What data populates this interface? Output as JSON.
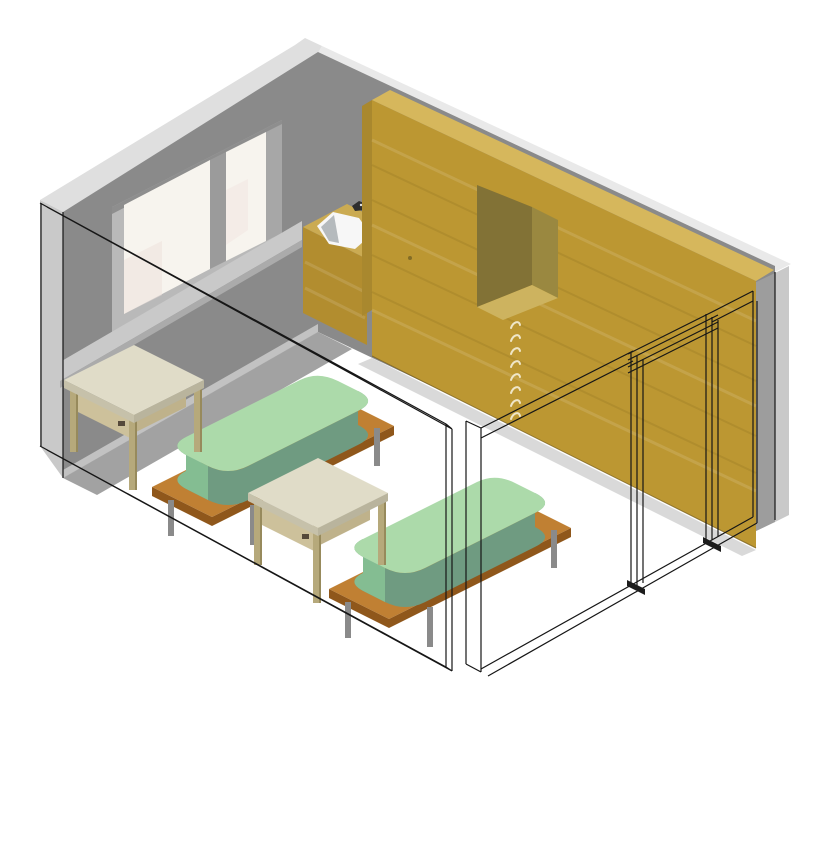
{
  "scene": {
    "view": "isometric-3d-room",
    "background": "#FFFFFF",
    "palette": {
      "outline": "#161616",
      "wall_gray": "#8A8A8A",
      "wall_gray_right": "#9D9D9D",
      "wall_cut_light": "#C9C9C9",
      "wall_top_band_left": "#DFDFDF",
      "wall_top_band_right": "#E9E9E9",
      "sill_band": "#C9C9C9",
      "sill_edge": "#ABABAB",
      "baseboard": "#C2C2C2",
      "floor_shadow": "#A2A2A2",
      "shadow_soft": "#ABABAB",
      "window_reveal": "#B9B9B9",
      "window_reveal_dark": "#8E8E8E",
      "window_pane": "#F7F4EE",
      "window_tint": "#EFE2DC",
      "window_mullion": "#9B9B9B",
      "window_frame_right": "#A7A7A7",
      "cabinet_front": "#BC9732",
      "cabinet_top": "#D6B75C",
      "cabinet_side": "#A9882E",
      "cabinet_base_line": "#7A621F",
      "niche_back": "#827236",
      "niche_jamb": "#9A8840",
      "niche_sill": "#CDB35F",
      "handle": "#EFE6C8",
      "keyhole": "#6B5A1F",
      "counter_front": "#B28D2F",
      "counter_top": "#CBAB52",
      "basin": "#F7F7F7",
      "basin_shadow": "#A9AFB3",
      "faucet": "#2E2E2E",
      "mattress_top": "#ACDAAA",
      "mattress_side": "#6F9B81",
      "mattress_end": "#84BD92",
      "platform_top": "#C08033",
      "platform_side": "#8F571B",
      "bed_leg": "#8A8A8A",
      "table_top": "#E0DCC8",
      "table_edge_a": "#C6C1AA",
      "table_edge_b": "#B9B49D",
      "table_leg": "#B6A97B",
      "table_leg_dark": "#978A5C",
      "table_apron": "#CDC19B",
      "table_apron_b": "#BFB28B",
      "drawer_pull_dark": "#55493A",
      "door_foot": "#1C1C1C"
    },
    "objects": [
      {
        "id": "room-shell",
        "label": "room shell with section-cut front walls"
      },
      {
        "id": "window",
        "label": "two-pane window in gray wall"
      },
      {
        "id": "sink-counter",
        "label": "wood counter with inset sink and faucet"
      },
      {
        "id": "wardrobe",
        "label": "full-height wood wardrobe with niche and drawer pulls"
      },
      {
        "id": "door-frame",
        "label": "wireframe door frame in cut wall"
      },
      {
        "id": "bed-1",
        "label": "bed with green mattress on wood platform"
      },
      {
        "id": "bed-2",
        "label": "bed with green mattress on wood platform"
      },
      {
        "id": "table-1",
        "label": "wood table"
      },
      {
        "id": "table-2",
        "label": "wood table"
      }
    ]
  }
}
